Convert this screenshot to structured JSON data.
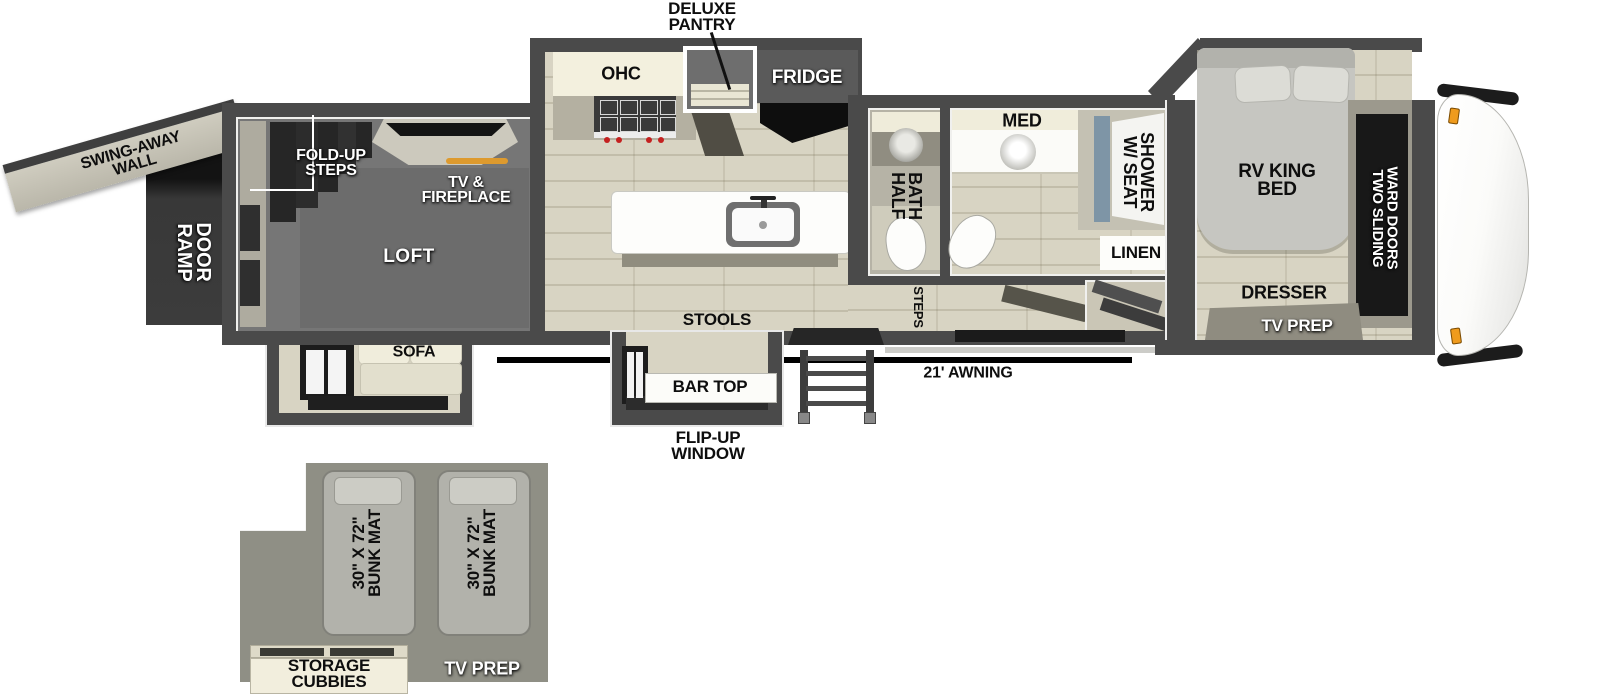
{
  "labels": {
    "deluxe_pantry": "DELUXE\nPANTRY",
    "ohc": "OHC",
    "fridge": "FRIDGE",
    "swing_away_wall": "SWING-AWAY\nWALL",
    "ramp_door": "RAMP\nDOOR",
    "fold_up_steps": "FOLD-UP\nSTEPS",
    "tv_fireplace": "TV &\nFIREPLACE",
    "loft": "LOFT",
    "sofa": "SOFA",
    "stools": "STOOLS",
    "bar_top": "BAR TOP",
    "flip_up_window": "FLIP-UP\nWINDOW",
    "awning": "21' AWNING",
    "half_bath": "HALF\nBATH",
    "steps": "STEPS",
    "med": "MED",
    "shower_w_seat": "SHOWER\nW/ SEAT",
    "linen": "LINEN",
    "rv_king_bed": "RV KING\nBED",
    "ward_doors": "TWO SLIDING\nWARD DOORS",
    "dresser": "DRESSER",
    "tv_prep": "TV PREP",
    "bunk_mat": "30\" X 72\"\nBUNK MAT",
    "storage_cubbies": "STORAGE\nCUBBIES"
  },
  "colors": {
    "wall": "#4a4a4a",
    "floor_beige": "#d8d4c3",
    "garage_floor": "#767676",
    "cabinet_cream": "#f2efdd",
    "fridge_gray": "#5a5a5a",
    "glass_blue": "#7e95a6",
    "marker_light_orange": "#ef9b1d",
    "fireplace_glow": "#e0992e",
    "awning_line": "#000000",
    "label_dark": "#0e0e0e",
    "label_light": "#ffffff"
  }
}
